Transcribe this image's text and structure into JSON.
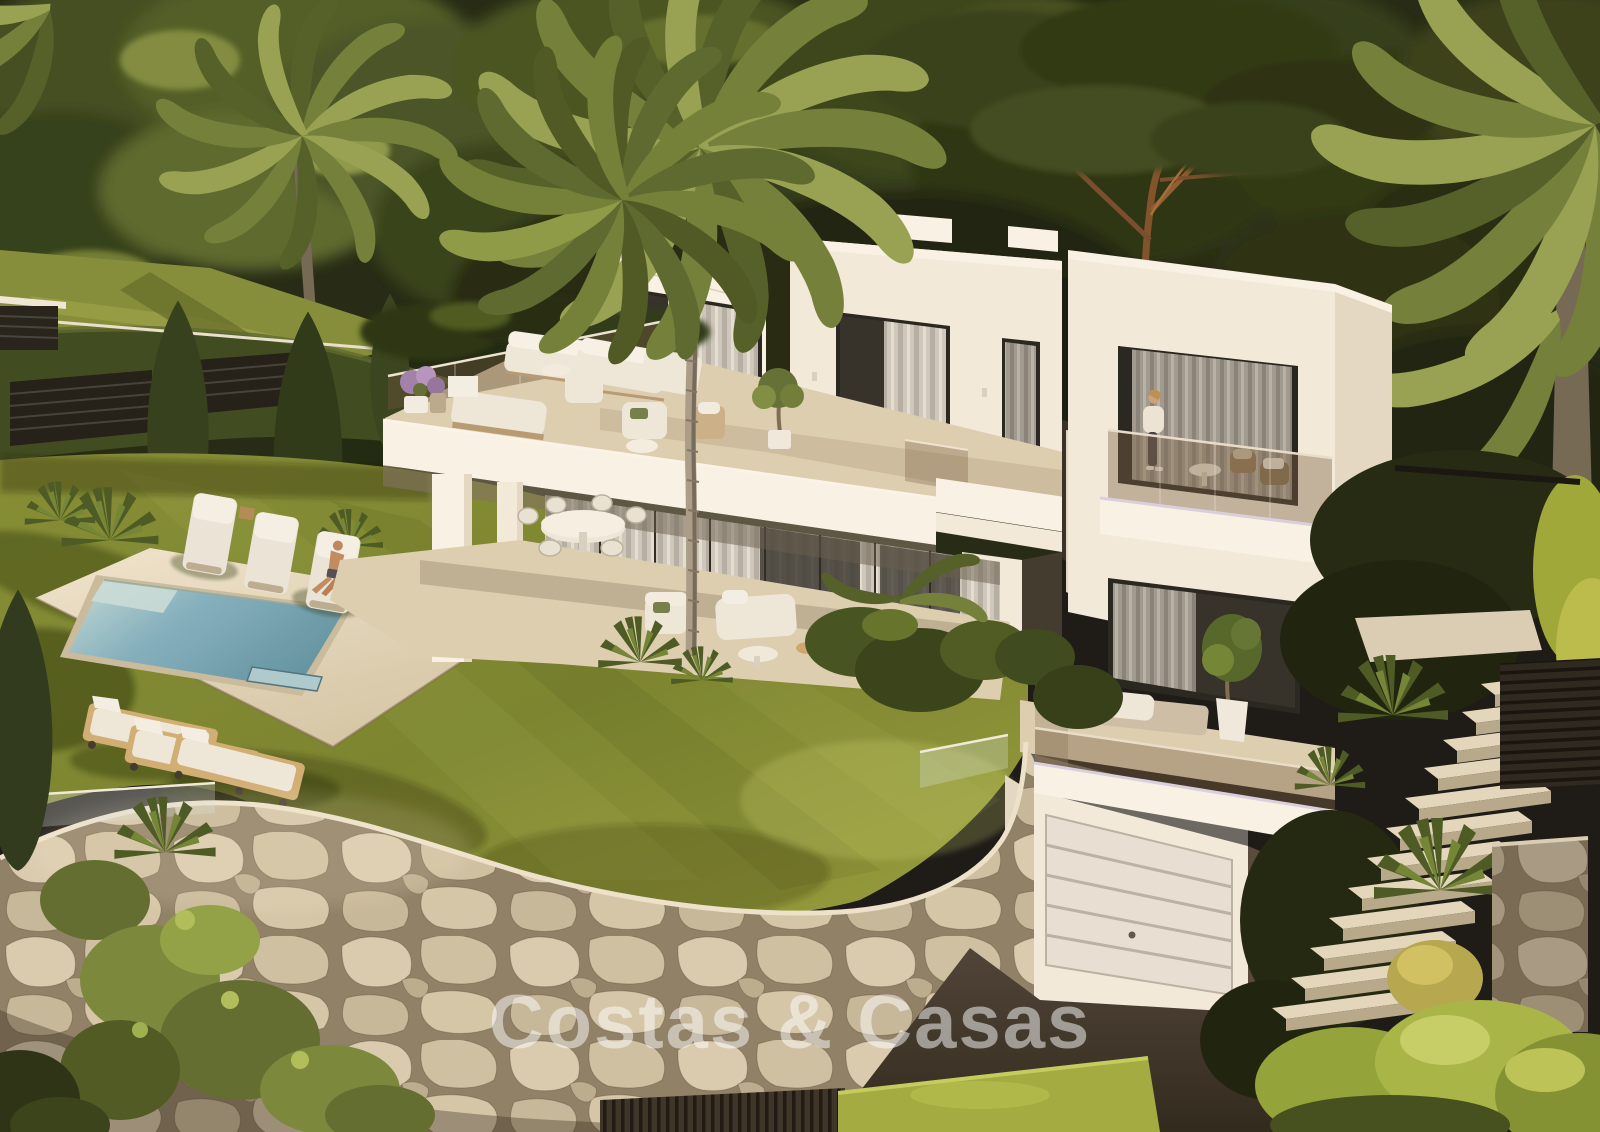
{
  "image": {
    "kind": "architectural-3d-render",
    "subject": "modern two-storey white villa with infinity garden, swimming pool, sun loungers, stone retaining wall and garage",
    "setting": "hillside mediterranean garden with palms and pine trees, warm evening light"
  },
  "watermark": {
    "text": "Costas & Casas"
  },
  "people": [
    {
      "label": "man-sunbathing-on-lounger"
    },
    {
      "label": "woman-standing-on-balcony"
    }
  ],
  "palette": {
    "wall": "#f3ecdf",
    "wallBright": "#f9f5eb",
    "wallShade": "#e4dac8",
    "slabShadow": "#7b7060",
    "glassDark": "#2b2b27",
    "frame": "#1e1e1c",
    "curtain": "#cbc7be",
    "curtainDark": "#9d9991",
    "floorBeige": "#dcd0b4",
    "deck": "#e8dfc8",
    "deckShade": "#c9bda0",
    "grass": "#7d892f",
    "grassLight": "#98a23d",
    "grassDark": "#5a661f",
    "treeDark": "#1a220d",
    "treeMid": "#2e3a16",
    "treeLight": "#55652a",
    "palm": "#6d7d38",
    "palmLight": "#93a150",
    "palmDark": "#4c5c26",
    "pineTrunk": "#7c4e28",
    "poolShallow": "#bcd8da",
    "poolDeep": "#5f93a6",
    "stoneLight": "#d8cdb3",
    "stoneJoint": "#887c64",
    "drive": "#38312a",
    "wood": "#c9a96e",
    "cushion": "#edeadf",
    "watermarkColor": "rgba(255,255,255,0.5)"
  }
}
